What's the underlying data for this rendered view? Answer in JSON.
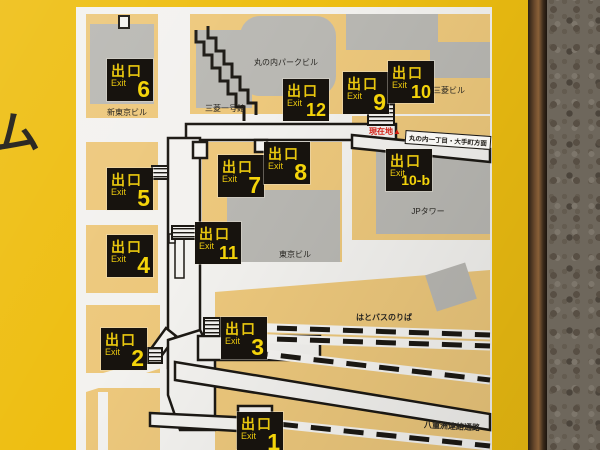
{
  "sign": {
    "left_partial_text": "ム",
    "colors": {
      "sign_yellow": "#eebe11",
      "panel_white": "#f3f2ef",
      "block_tan": "#edc87c",
      "building_gray": "#b9b8b3",
      "line_black": "#1c1914",
      "badge_black": "#17130e",
      "badge_text_yellow": "#f4d40a",
      "marker_red": "#d21d12"
    }
  },
  "map": {
    "exit_word_jp": "出口",
    "exit_word_en": "Exit",
    "exit_numbers": [
      "6",
      "12",
      "9",
      "10",
      "5",
      "7",
      "8",
      "10-b",
      "4",
      "11",
      "2",
      "3",
      "1"
    ],
    "buildings": [
      "新東京ビル",
      "三菱一号館",
      "丸の内パークビル",
      "三菱ビル",
      "JPタワー",
      "東京ビル"
    ],
    "areas": [
      "はとバスのりば",
      "八重洲連絡通路"
    ],
    "current_location_label": "現在地▲",
    "direction_label": "丸の内一丁目・大手町方面"
  }
}
